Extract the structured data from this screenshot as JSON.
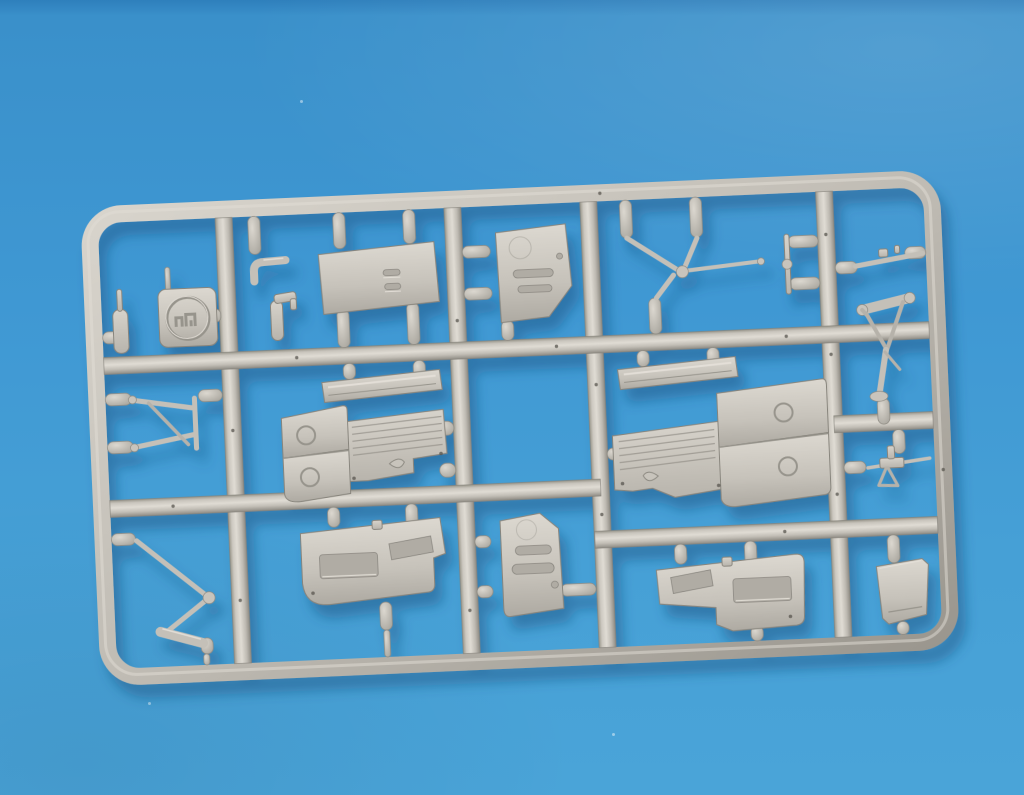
{
  "scene": {
    "description": "Photograph of a light grey injection-moulded model kit sprue (plastic parts frame) lying on a blue background, lit from the upper left with a soft blue shadow cast down and to the right.",
    "object": "model-kit-sprue",
    "rotation_deg": -2.5,
    "palette": {
      "background_top": "#2e7fbc",
      "background_base": "#3f98d3",
      "background_bottom": "#4aa4d8",
      "plastic_light": "#e0dcd4",
      "plastic_base": "#c2beb6",
      "plastic_dark": "#8e8b83",
      "plastic_outline": "#87847c",
      "shadow": "#1a4a78"
    },
    "frame": {
      "shape": "rounded-rectangle",
      "vertical_runners": 4,
      "horizontal_runners": 4,
      "grid": "3 rows x 5 columns of cells"
    },
    "parts": [
      {
        "name": "maker-logo-tab",
        "cell": "top-left",
        "detail": "square tab with embossed circular monogram"
      },
      {
        "name": "post-with-pin",
        "cell": "top-left"
      },
      {
        "name": "bent-elbow-lever",
        "cell": "top-second"
      },
      {
        "name": "pump-handle",
        "cell": "top-second"
      },
      {
        "name": "slotted-rectangular-panel",
        "cell": "top-second",
        "detail": "two small vents"
      },
      {
        "name": "door-panel-with-vents",
        "cell": "top-third",
        "detail": "clipped lower corner, two louvres"
      },
      {
        "name": "wishbone-strut",
        "cell": "top-fourth"
      },
      {
        "name": "twin-pin-rod",
        "cell": "top-fourth"
      },
      {
        "name": "long-control-rod",
        "cell": "top-right"
      },
      {
        "name": "landing-gear-leg",
        "cell": "top-right",
        "detail": "bar, zigzag braces and oleo foot"
      },
      {
        "name": "machine-gun",
        "cell": "mid-right"
      },
      {
        "name": "tripod-strut-frame",
        "cell": "mid-left"
      },
      {
        "name": "rectangular-strip-left",
        "cell": "center-left"
      },
      {
        "name": "wing-flap-assembly-left",
        "cell": "center-left",
        "detail": "two round-marked panels plus ribbed flap section"
      },
      {
        "name": "rectangular-strip-right",
        "cell": "center-right"
      },
      {
        "name": "wing-flap-assembly-right",
        "cell": "center-right",
        "detail": "mirror of left assembly"
      },
      {
        "name": "zigzag-skid-strut",
        "cell": "bottom-left"
      },
      {
        "name": "fuselage-side-panel-left",
        "cell": "bottom-second",
        "detail": "two window recesses"
      },
      {
        "name": "cabin-door-panel",
        "cell": "bottom-center",
        "detail": "two louvre slots"
      },
      {
        "name": "fuselage-side-panel-right",
        "cell": "bottom-third",
        "detail": "mirror of left panel"
      },
      {
        "name": "trapezoid-panel",
        "cell": "bottom-right"
      }
    ],
    "gate_count": 34
  }
}
